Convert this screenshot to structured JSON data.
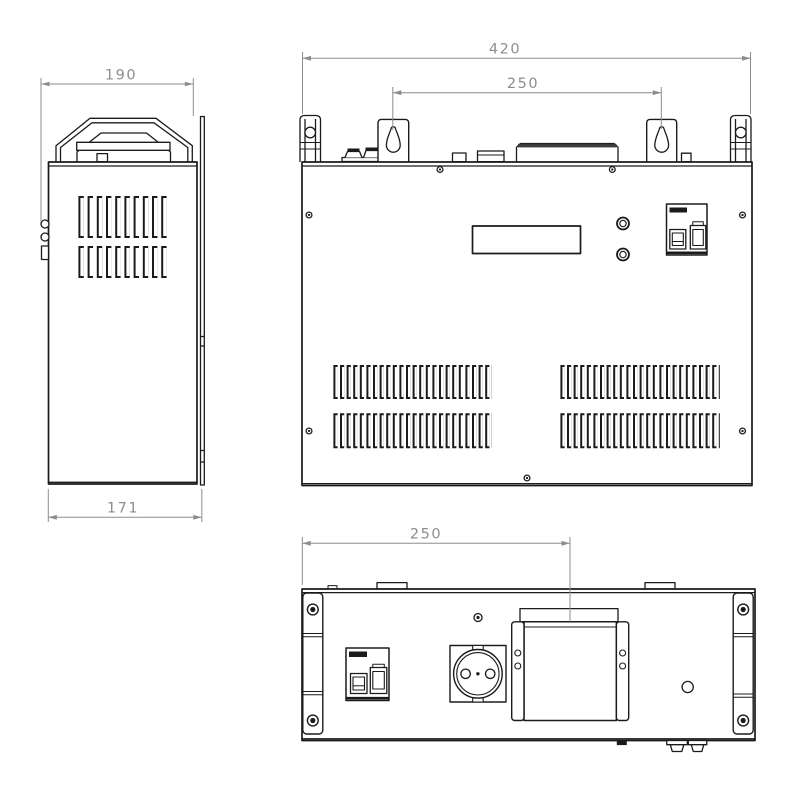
{
  "drawing": {
    "background": "#ffffff",
    "colors": {
      "outline": "#1b1b1b",
      "dimension": "#8d8d8d"
    },
    "views": {
      "side": {
        "dim_overall_depth": "190",
        "dim_body_depth": "171",
        "components": [
          "carry-handle",
          "vent-grille",
          "door-latch",
          "rear-mounting-flange"
        ]
      },
      "front": {
        "dim_overall_width": "420",
        "dim_keyhole_spacing": "250",
        "components": [
          "carry-handle-ends",
          "keyhole-mounting-brackets",
          "terminal-studs",
          "display-window",
          "control-buttons",
          "circuit-breaker",
          "vent-grilles",
          "panel-screws"
        ]
      },
      "bottom": {
        "dim_terminal_cover_offset": "250",
        "components": [
          "corner-rails",
          "circuit-breaker",
          "power-socket",
          "terminal-cover",
          "cable-glands",
          "vent-hole"
        ]
      }
    }
  }
}
